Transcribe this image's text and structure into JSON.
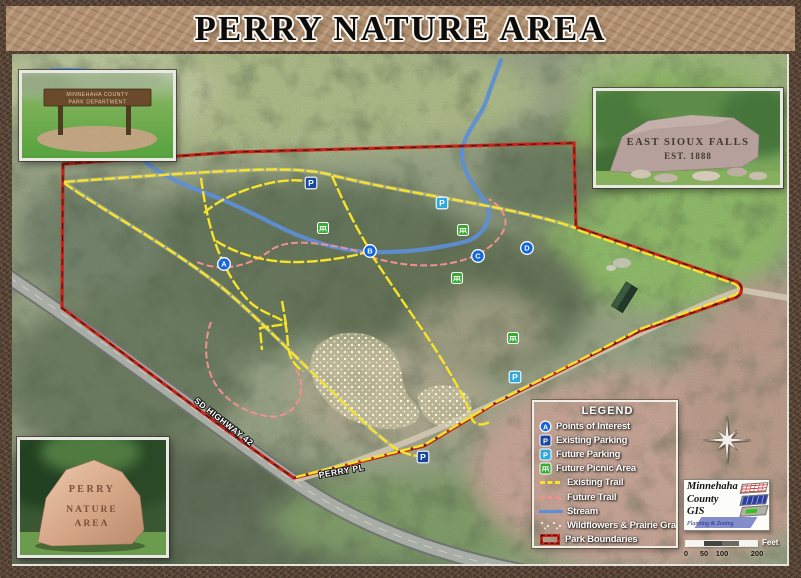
{
  "title": "PERRY NATURE AREA",
  "legend": {
    "title": "LEGEND",
    "items": [
      {
        "icon": "poi",
        "letter": "A",
        "label": "Points of Interest"
      },
      {
        "icon": "parking-existing",
        "letter": "P",
        "label": "Existing Parking"
      },
      {
        "icon": "parking-future",
        "letter": "P",
        "label": "Future Parking"
      },
      {
        "icon": "picnic",
        "label": "Future Picnic Area"
      },
      {
        "icon": "trail-existing",
        "label": "Existing Trail"
      },
      {
        "icon": "trail-future",
        "label": "Future Trail"
      },
      {
        "icon": "stream",
        "label": "Stream"
      },
      {
        "icon": "wildflowers",
        "label": "Wildflowers & Prairie Grass"
      },
      {
        "icon": "boundary",
        "label": "Park Boundaries"
      }
    ]
  },
  "map": {
    "road_labels": [
      {
        "text": "SD HIGHWAY 42"
      },
      {
        "text": "PERRY PL"
      }
    ],
    "markers": [
      {
        "type": "poi",
        "label": "A",
        "x": 224,
        "y": 264
      },
      {
        "type": "poi",
        "label": "B",
        "x": 370,
        "y": 251
      },
      {
        "type": "poi",
        "label": "C",
        "x": 478,
        "y": 256
      },
      {
        "type": "poi",
        "label": "D",
        "x": 527,
        "y": 248
      },
      {
        "type": "parking-existing",
        "label": "P",
        "x": 311,
        "y": 183
      },
      {
        "type": "parking-existing",
        "label": "P",
        "x": 423,
        "y": 457
      },
      {
        "type": "parking-future",
        "label": "P",
        "x": 442,
        "y": 203
      },
      {
        "type": "parking-future",
        "label": "P",
        "x": 515,
        "y": 377
      },
      {
        "type": "picnic",
        "x": 323,
        "y": 228
      },
      {
        "type": "picnic",
        "x": 463,
        "y": 230
      },
      {
        "type": "picnic",
        "x": 457,
        "y": 278
      },
      {
        "type": "picnic",
        "x": 513,
        "y": 338
      }
    ]
  },
  "scale_bar": {
    "ticks": [
      "0",
      "50",
      "100",
      "200"
    ],
    "unit": "Feet"
  },
  "gis_logo": {
    "name_lines": [
      "Minnehaha",
      "County",
      "GIS"
    ],
    "department": "Planning & Zoning"
  },
  "insets": {
    "county_sign": {
      "line1": "MINNEHAHA COUNTY",
      "line2": "PARK DEPARTMENT"
    },
    "east_sioux_falls_stone": {
      "line1": "EAST SIOUX FALLS",
      "line2": "EST. 1888"
    },
    "perry_stone": {
      "line1": "PERRY",
      "line2": "NATURE",
      "line3": "AREA"
    }
  },
  "colors": {
    "poi": "#1565d8",
    "parking_existing": "#17479e",
    "parking_future": "#2fa8de",
    "picnic": "#3aaa35",
    "trail_existing": "#f7e32a",
    "trail_future": "#f09090",
    "stream": "#5d8ed6",
    "boundary": "#c6251a"
  }
}
